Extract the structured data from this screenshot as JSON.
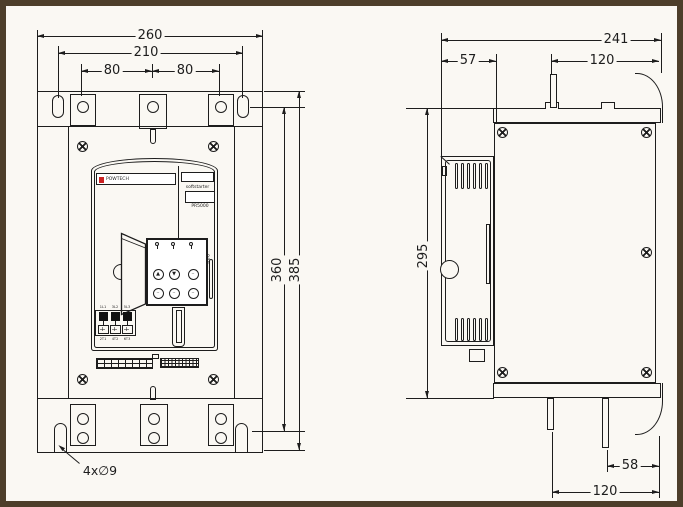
{
  "drawing": {
    "front": {
      "dims": {
        "width_outer": "260",
        "width_holes": "210",
        "pitch_left": "80",
        "pitch_right": "80",
        "height_holes": "360",
        "height_outer": "385",
        "hole_note": "4x∅9"
      },
      "panel": {
        "brand": "POWTECH",
        "product": "softstarter",
        "model": "PR5000",
        "keypad": {
          "display": "888",
          "btn_up": "▲",
          "btn_down": "▼",
          "btn_f1": "··",
          "btn_f2": "··",
          "btn_f3": "··",
          "btn_f4": "··"
        },
        "terminals": {
          "top": [
            "1L1",
            "3L2",
            "5L3"
          ],
          "bottom": [
            "2T1",
            "4T2",
            "6T3"
          ]
        }
      }
    },
    "side": {
      "dims": {
        "depth_outer": "241",
        "door_depth": "57",
        "busbar_top": "120",
        "body_height": "295",
        "busbar_offset": "58",
        "busbar_bottom": "120"
      }
    }
  }
}
